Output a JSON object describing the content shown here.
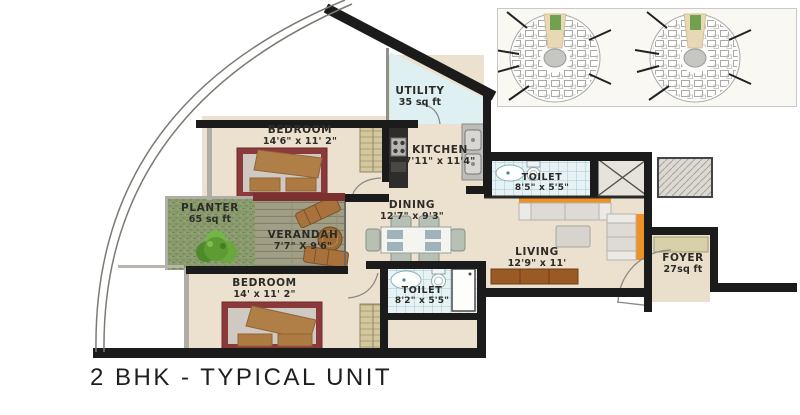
{
  "title": "2 BHK - TYPICAL UNIT",
  "rooms": {
    "bedroom1": {
      "name": "BEDROOM",
      "dims": "14'6\" x 11' 2\""
    },
    "utility": {
      "name": "UTILITY",
      "dims": "35 sq ft"
    },
    "kitchen": {
      "name": "KITCHEN",
      "dims": "7'11\" x 11'4\""
    },
    "toilet1": {
      "name": "TOILET",
      "dims": "8'5\" x 5'5\""
    },
    "planter": {
      "name": "PLANTER",
      "dims": "65 sq ft"
    },
    "verandah": {
      "name": "VERANDAH",
      "dims": "7'7\" X 9'6\""
    },
    "dining": {
      "name": "DINING",
      "dims": "12'7\" x 9'3\""
    },
    "living": {
      "name": "LIVING",
      "dims": "12'9\" x 11'"
    },
    "bedroom2": {
      "name": "BEDROOM",
      "dims": "14' x 11' 2\""
    },
    "toilet2": {
      "name": "TOILET",
      "dims": "8'2\" x 5'5\""
    },
    "foyer": {
      "name": "FOYER",
      "dims": "27sq ft"
    }
  },
  "key_plan": {
    "description": "tower key plan",
    "circles": 2
  },
  "colors": {
    "wall": "#1b1b1b",
    "floor_beige": "#ece1cf",
    "tile_blue": "#e7f2f5",
    "planter_green": "#8a9b6e",
    "bed_frame_red": "#8a3a3a",
    "accent_orange": "#ef9226",
    "wood_brown": "#a9713c",
    "keyplan_green": "#71a04f",
    "keyplan_tan": "#e9d8b6"
  }
}
